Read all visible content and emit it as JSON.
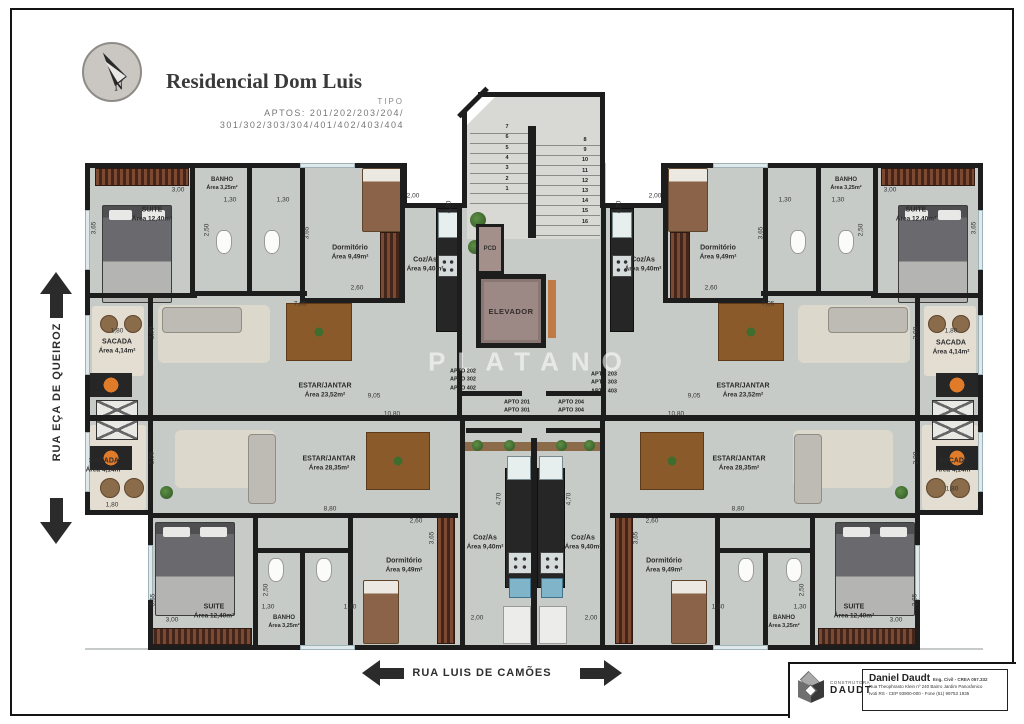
{
  "colors": {
    "floor": "#c6cbc8",
    "wall": "#1d1d1d",
    "elevator_cab": "#9c8884",
    "wood": "#8b5a2b",
    "street_arrow": "#2b2b2b"
  },
  "compass": {
    "label": "N"
  },
  "title_block": {
    "title": "Residencial Dom Luis",
    "subtitle": "TIPO",
    "aptos_line1": "APTOS: 201/202/203/204/",
    "aptos_line2": "301/302/303/304/401/402/403/404"
  },
  "streets": {
    "left": "RUA EÇA DE QUEIROZ",
    "bottom": "RUA LUIS DE CAMÕES"
  },
  "plan": {
    "watermark": "PLATANO",
    "core": {
      "elevator_label": "ELEVADOR",
      "pcd_label": "PCD"
    },
    "stairs": {
      "left": [
        "7",
        "6",
        "5",
        "4",
        "3",
        "2",
        "1"
      ],
      "right": [
        "8",
        "9",
        "10",
        "11",
        "12",
        "13",
        "14",
        "15",
        "16"
      ]
    },
    "apto_groups": [
      {
        "x": 463,
        "y": 380,
        "lines": [
          "APTO 202",
          "APTO 302",
          "APTO 402"
        ]
      },
      {
        "x": 604,
        "y": 383,
        "lines": [
          "APTO 203",
          "APTO 303",
          "APTO 403"
        ]
      },
      {
        "x": 517,
        "y": 411,
        "lines": [
          "APTO 201",
          "APTO 301",
          "APTO 401"
        ]
      },
      {
        "x": 571,
        "y": 411,
        "lines": [
          "APTO 204",
          "APTO 304",
          "APTO 404"
        ]
      }
    ],
    "rooms": [
      [
        "SUITE",
        "Área 12,40m²",
        152,
        215,
        0
      ],
      [
        "BANHO",
        "Área 3,25m²",
        222,
        184,
        1
      ],
      [
        "Dormitório",
        "Área 9,49m²",
        350,
        253,
        0
      ],
      [
        "Coz/As",
        "Área 9,40m²",
        425,
        265,
        0
      ],
      [
        "SACADA",
        "Área 4,14m²",
        117,
        347,
        0
      ],
      [
        "ESTAR/JANTAR",
        "Área 23,52m²",
        325,
        391,
        0
      ],
      [
        "SACADA",
        "Área 4,14m²",
        104,
        466,
        0
      ],
      [
        "ESTAR/JANTAR",
        "Área 28,35m²",
        329,
        464,
        0
      ],
      [
        "Coz/As",
        "Área 9,40m²",
        485,
        543,
        0
      ],
      [
        "Dormitório",
        "Área 9,49m²",
        404,
        566,
        0
      ],
      [
        "BANHO",
        "Área 3,25m²",
        284,
        622,
        1
      ],
      [
        "SUITE",
        "Área 12,40m²",
        214,
        612,
        0
      ],
      [
        "Coz/As",
        "Área 9,40m²",
        643,
        265,
        0
      ],
      [
        "Dormitório",
        "Área 9,49m²",
        718,
        253,
        0
      ],
      [
        "BANHO",
        "Área 3,25m²",
        846,
        184,
        1
      ],
      [
        "SUITE",
        "Área 12,40m²",
        916,
        215,
        0
      ],
      [
        "ESTAR/JANTAR",
        "Área 23,52m²",
        743,
        391,
        0
      ],
      [
        "SACADA",
        "Área 4,14m²",
        951,
        348,
        0
      ],
      [
        "Coz/As",
        "Área 9,40m²",
        583,
        543,
        0
      ],
      [
        "ESTAR/JANTAR",
        "Área 28,35m²",
        739,
        464,
        0
      ],
      [
        "Dormitório",
        "Área 9,49m²",
        664,
        566,
        0
      ],
      [
        "BANHO",
        "Área 3,25m²",
        784,
        622,
        1
      ],
      [
        "SUITE",
        "Área 12,40m²",
        854,
        612,
        0
      ],
      [
        "SACADA",
        "Área 4,14m²",
        954,
        466,
        0
      ]
    ],
    "dimensions": [
      [
        "3,00",
        178,
        190,
        0
      ],
      [
        "3,65",
        94,
        228,
        1
      ],
      [
        "1,30",
        230,
        200,
        0
      ],
      [
        "2,50",
        207,
        230,
        1
      ],
      [
        "1,30",
        283,
        200,
        0
      ],
      [
        "3,65",
        307,
        233,
        1
      ],
      [
        "2,60",
        357,
        288,
        0
      ],
      [
        "2,00",
        413,
        196,
        0
      ],
      [
        "4,70",
        449,
        207,
        1
      ],
      [
        "7,05",
        300,
        304,
        0
      ],
      [
        "1,80",
        117,
        331,
        0
      ],
      [
        "2,90",
        152,
        333,
        1
      ],
      [
        "9,05",
        374,
        396,
        0
      ],
      [
        "10,80",
        392,
        414,
        0
      ],
      [
        "2,00",
        152,
        458,
        1
      ],
      [
        "1,80",
        112,
        505,
        0
      ],
      [
        "8,80",
        330,
        509,
        0
      ],
      [
        "2,60",
        416,
        521,
        0
      ],
      [
        "3,65",
        432,
        538,
        1
      ],
      [
        "2,50",
        266,
        590,
        1
      ],
      [
        "1,30",
        268,
        607,
        0
      ],
      [
        "1,30",
        350,
        607,
        0
      ],
      [
        "3,00",
        172,
        620,
        0
      ],
      [
        "3,65",
        153,
        600,
        1
      ],
      [
        "4,70",
        499,
        499,
        1
      ],
      [
        "2,00",
        477,
        618,
        0
      ],
      [
        "2,00",
        655,
        196,
        0
      ],
      [
        "4,70",
        619,
        207,
        1
      ],
      [
        "3,00",
        890,
        190,
        0
      ],
      [
        "3,65",
        974,
        228,
        1
      ],
      [
        "1,30",
        838,
        200,
        0
      ],
      [
        "2,50",
        861,
        230,
        1
      ],
      [
        "1,30",
        785,
        200,
        0
      ],
      [
        "3,65",
        761,
        233,
        1
      ],
      [
        "2,60",
        711,
        288,
        0
      ],
      [
        "7,05",
        768,
        304,
        0
      ],
      [
        "1,80",
        951,
        331,
        0
      ],
      [
        "2,90",
        916,
        333,
        1
      ],
      [
        "9,05",
        694,
        396,
        0
      ],
      [
        "10,80",
        676,
        414,
        0
      ],
      [
        "2,00",
        916,
        458,
        1
      ],
      [
        "1,80",
        952,
        489,
        0
      ],
      [
        "8,80",
        738,
        509,
        0
      ],
      [
        "2,60",
        652,
        521,
        0
      ],
      [
        "3,65",
        636,
        538,
        1
      ],
      [
        "2,50",
        802,
        590,
        1
      ],
      [
        "1,30",
        800,
        607,
        0
      ],
      [
        "1,30",
        718,
        607,
        0
      ],
      [
        "3,00",
        896,
        620,
        0
      ],
      [
        "3,65",
        915,
        600,
        1
      ],
      [
        "4,70",
        569,
        499,
        1
      ],
      [
        "2,00",
        591,
        618,
        0
      ]
    ]
  },
  "logo_block": {
    "company_line1": "CONSTRUTORA",
    "company_line2": "DAUDT",
    "engineer": "Daniel Daudt",
    "credentials": "Eng. Civil - CREA 057.332",
    "address_line1": "Rua Theophrasto Klein nº 240 Bairro Jardim Panorâmico",
    "address_line2": "Ivoti RS - CEP 93900-000 - Fone (51) 99753 1935"
  }
}
